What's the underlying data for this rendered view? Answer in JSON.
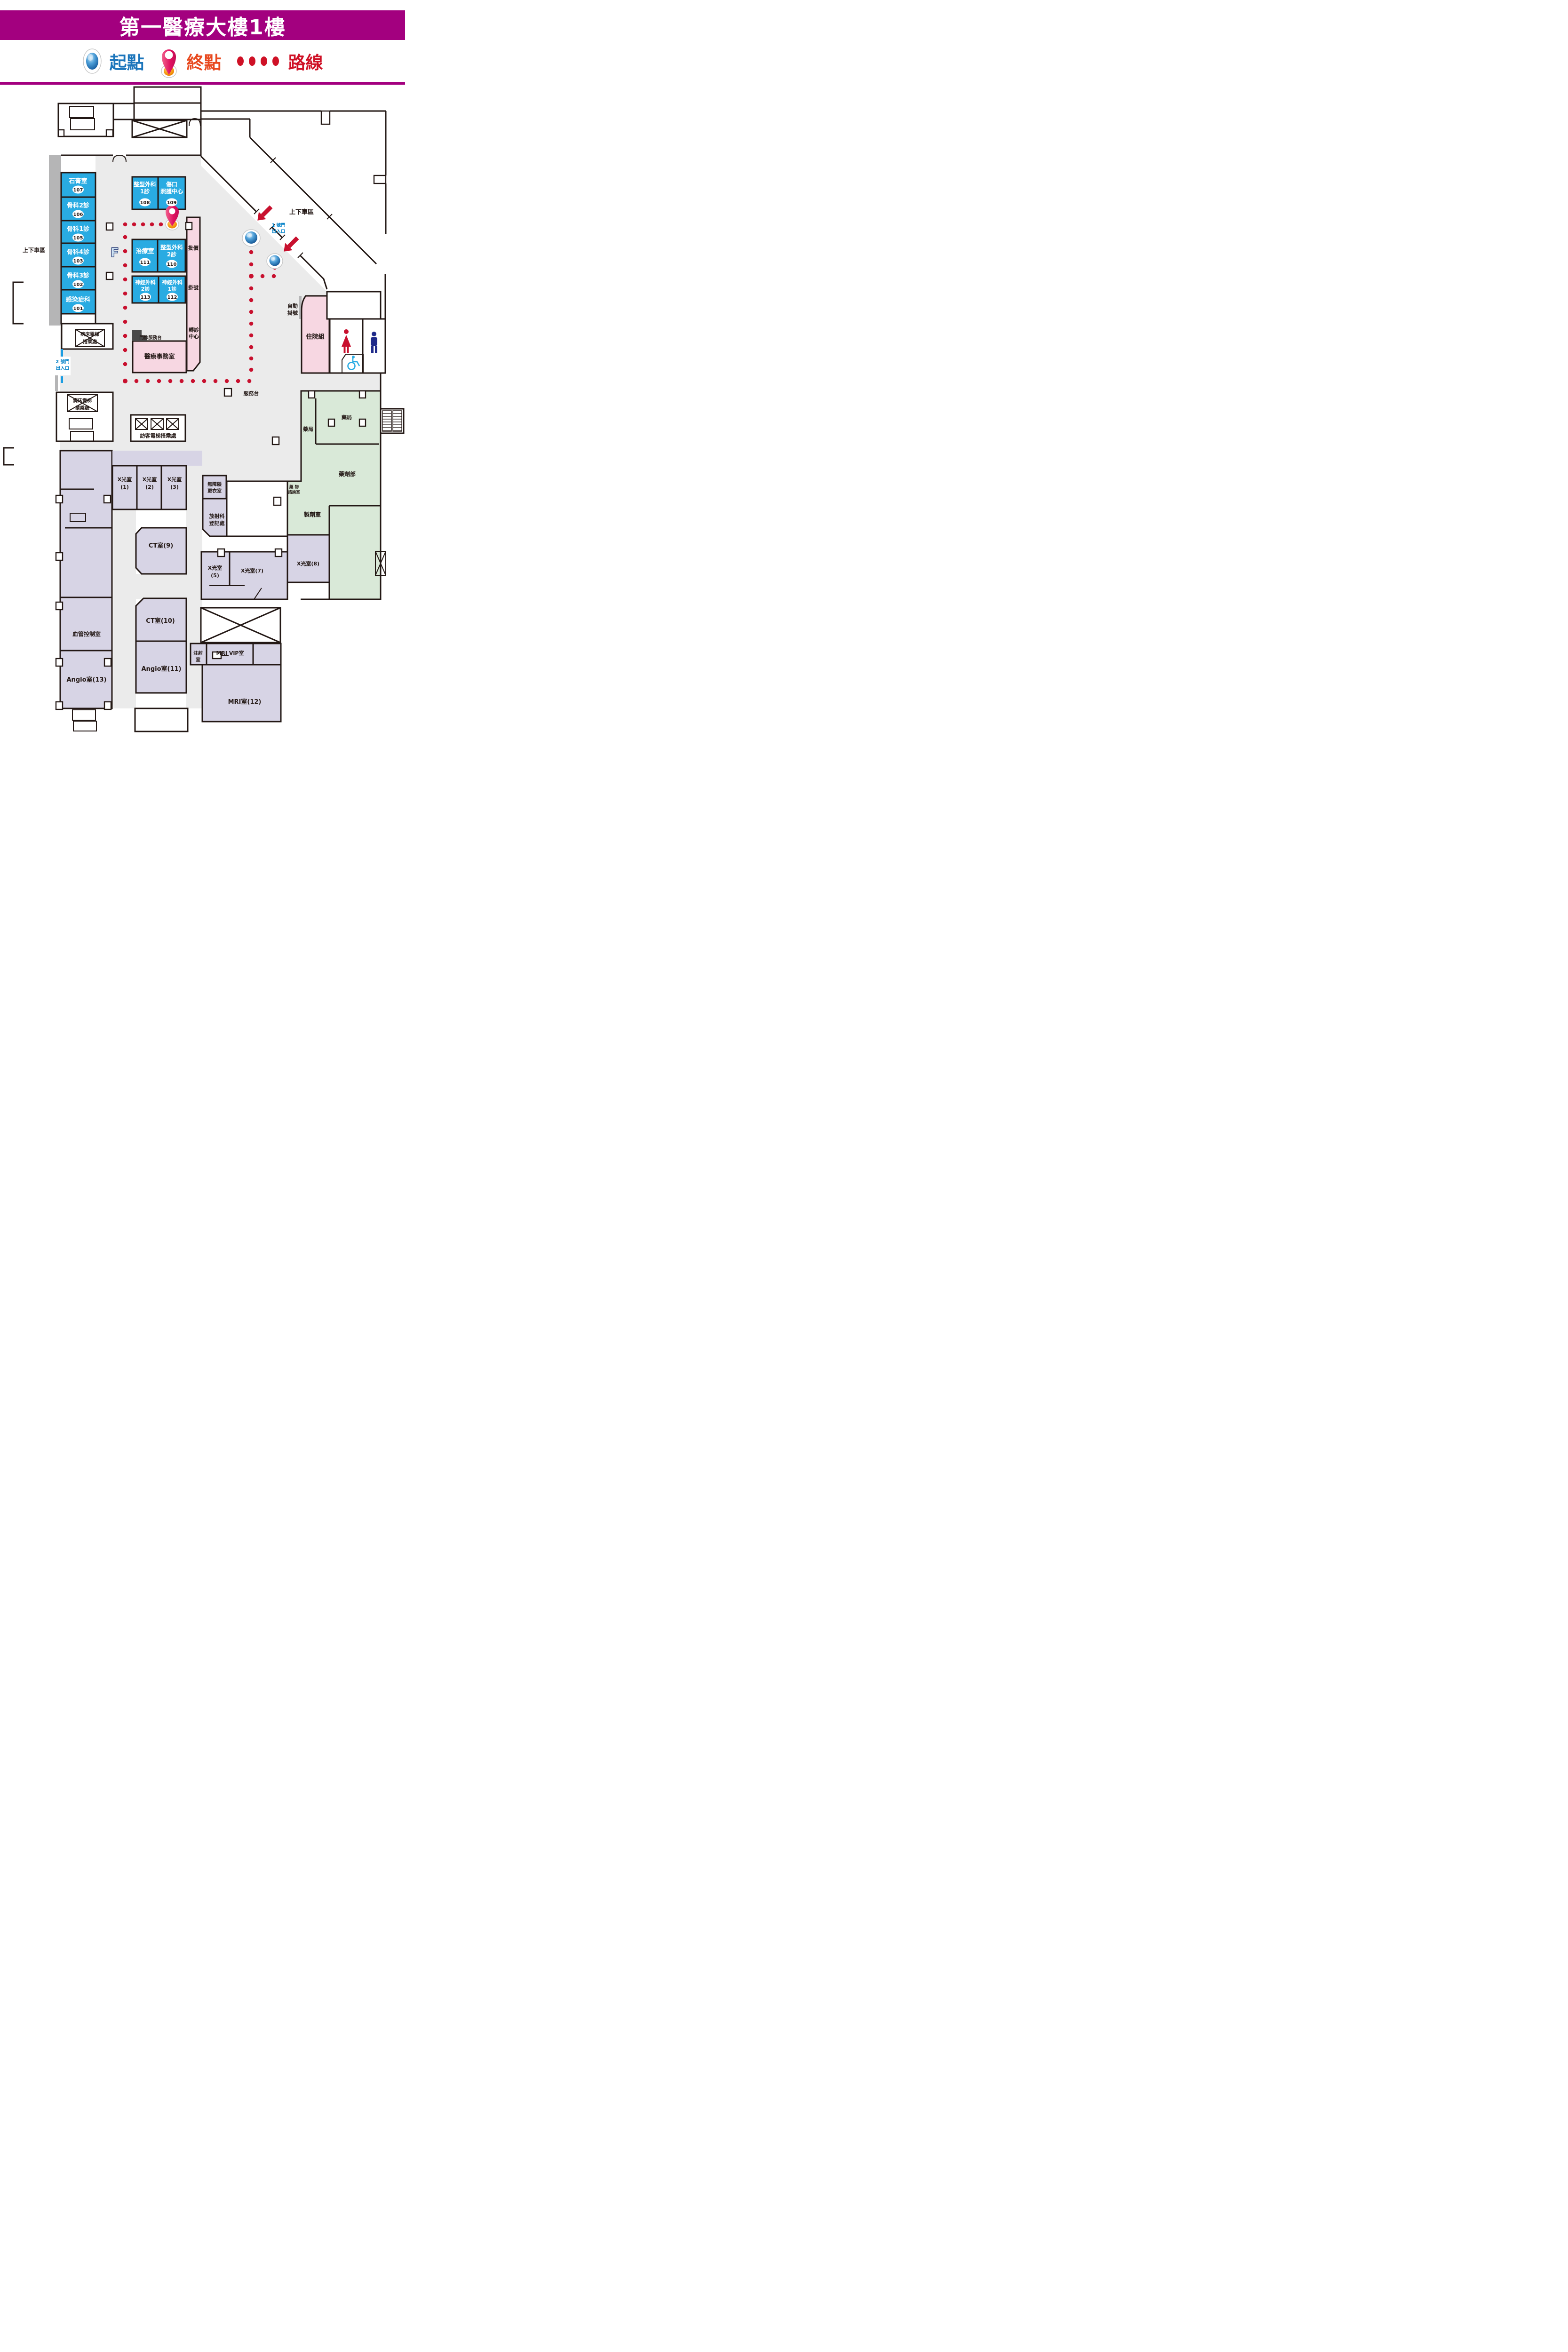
{
  "title": "第一醫療大樓1樓",
  "legend": {
    "start": "起點",
    "end": "終點",
    "route": "路線"
  },
  "colors": {
    "header": "#a3007f",
    "clinic_blue": "#29abe2",
    "pink_zone": "#f7d7e2",
    "green_zone": "#d9e9d8",
    "lavender_zone": "#d7d4e5",
    "corridor": "#ebebeb",
    "route_red": "#c8102e",
    "gate_blue": "#0080c8",
    "start_text": "#1b75bb",
    "end_text": "#e8491f",
    "route_text": "#cf1126"
  },
  "map": {
    "dropoff_left": "上下車區",
    "dropoff_right": "上下車區",
    "gate1": {
      "l1": "1 號門",
      "l2": "出入口"
    },
    "gate2": {
      "l1": "2 號門",
      "l2": "出入口"
    },
    "escalator_icon": "F",
    "blue_rooms": [
      {
        "name": "石膏室",
        "num": "107"
      },
      {
        "name": "骨科2診",
        "num": "106"
      },
      {
        "name": "骨科1診",
        "num": "105"
      },
      {
        "name": "骨科4診",
        "num": "103"
      },
      {
        "name": "骨科3診",
        "num": "102"
      },
      {
        "name": "感染症科",
        "num": "101"
      },
      {
        "l1": "整型外科",
        "l2": "1診",
        "num": "108"
      },
      {
        "l1": "傷口",
        "l2": "照護中心",
        "num": "109"
      },
      {
        "name": "治療室",
        "num": "111"
      },
      {
        "l1": "整型外科",
        "l2": "2診",
        "num": "110"
      },
      {
        "l1": "神經外科",
        "l2": "2診",
        "num": "113"
      },
      {
        "l1": "神經外科",
        "l2": "1診",
        "num": "112"
      }
    ],
    "labels": {
      "pijia": "批價",
      "guahao": "掛號",
      "zhuan1": "轉診",
      "zhuan2": "中心",
      "yiliao": "醫療事務室",
      "menzhen": "門診服務台",
      "zidong1": "自動",
      "zidong2": "掛號",
      "zhuyuan": "住院組",
      "fuwutai": "服務台",
      "bed_elev1_l1": "病床電梯",
      "bed_elev1_l2": "搭乘處",
      "bed_elev2_l1": "病床電梯",
      "bed_elev2_l2": "搭乘處",
      "visitor_elev": "訪客電梯搭乘處",
      "pharmacy_v": "藥局",
      "pharmacy_h": "藥局",
      "pharmacy_dept": "藥劑部",
      "drug_consult1": "藥 物",
      "drug_consult2": "諮詢室",
      "prep_room": "製劑室",
      "barrier_free1": "無障礙",
      "barrier_free2": "更衣室",
      "radiology1": "放射科",
      "radiology2": "登記處",
      "xray1_1": "X光室",
      "xray1_2": "(1)",
      "xray2_1": "X光室",
      "xray2_2": "(2)",
      "xray3_1": "X光室",
      "xray3_2": "(3)",
      "ct9": "CT室(9)",
      "ct10": "CT室(10)",
      "angio11": "Angio室(11)",
      "angio13": "Angio室(13)",
      "vascular": "血管控制室",
      "xray5_1": "X光室",
      "xray5_2": "(5)",
      "xray7": "X光室(7)",
      "xray8": "X光室(8)",
      "injection1": "注射",
      "injection2": "室",
      "mri_vip": "MRI VIP室",
      "mri12": "MRI室(12)"
    }
  }
}
